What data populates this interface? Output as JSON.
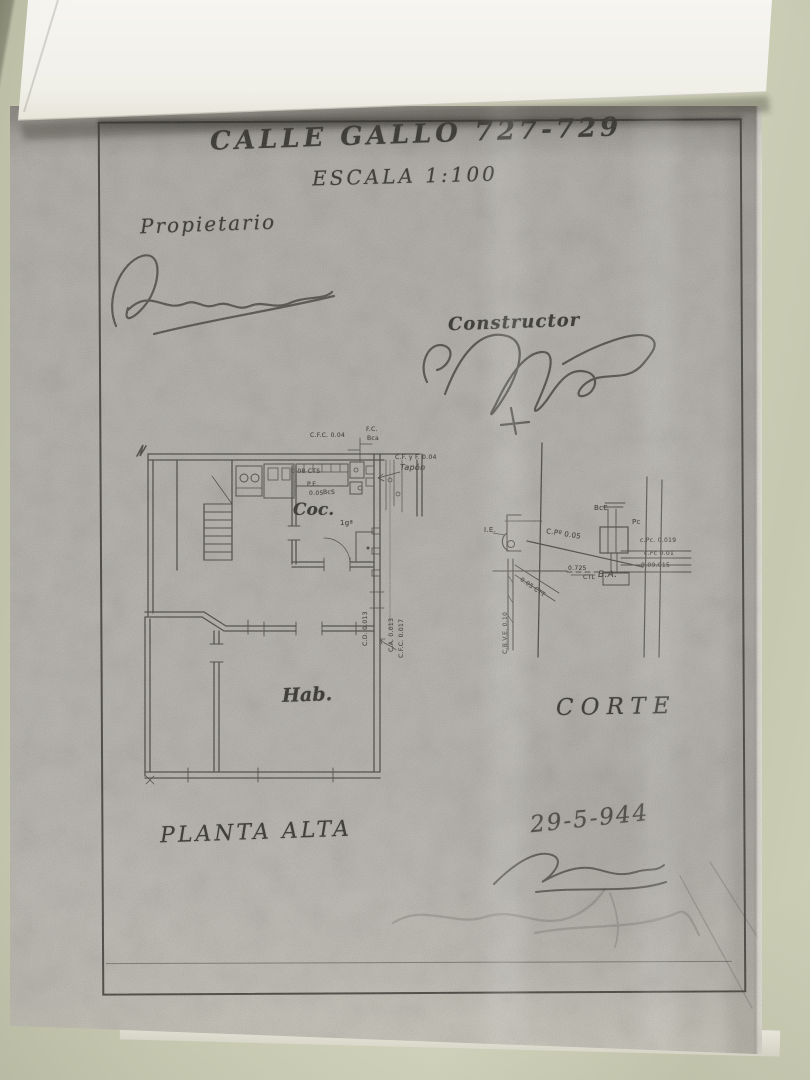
{
  "document": {
    "street_title": "CALLE GALLO 727-729",
    "scale_note": "ESCALA 1:100",
    "owner_label": "Propietario",
    "builder_label": "Constructor",
    "plan_caption": "PLANTA ALTA",
    "section_caption": "CORTE",
    "date_note": "29-5-944",
    "rooms": {
      "kitchen_abbr": "Coc.",
      "bedroom_abbr": "Hab."
    },
    "plan_notes": [
      "C.F.C. 0.04",
      "F.C.",
      "Bca",
      "0.08 CTS",
      "P.E.",
      "0.05",
      "BcS",
      "C.F. y F. 0.04",
      "Tapón",
      "1gª",
      "C.D. 0.013",
      "C.A. 0.013",
      "C.F.C. 0.017"
    ],
    "section_notes": [
      "I.E.",
      "C.Pº 0.05",
      "BcE",
      "Pc",
      "c.Pc. 0.019",
      "c.Pc 0.01",
      "0.09.015",
      "0.725",
      "CTL",
      "B.A.",
      "C.B.V.E. 0.10",
      "0.05 CTT"
    ]
  },
  "colors": {
    "table_surface": "#c9cbb3",
    "top_sheet": "#f2f1ec",
    "photocopy_paper": "#b4b1ab",
    "ink": "#36342e"
  }
}
